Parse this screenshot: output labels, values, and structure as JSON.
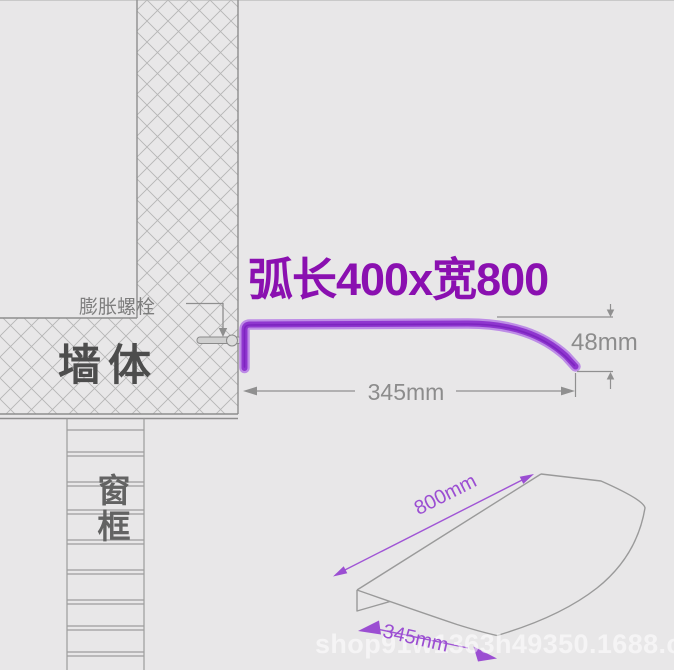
{
  "title": "弧长400x宽800",
  "cross_section": {
    "bolt_label": "膨胀螺栓",
    "wall_label": "墙体",
    "window_frame_label": "窗框",
    "dim_depth": "345mm",
    "dim_drop": "48mm"
  },
  "iso_view": {
    "dim_length": "800mm",
    "dim_depth": "345mm"
  },
  "watermark": "shop91w1363h49350.1688.com",
  "colors": {
    "background": "#e8e7e8",
    "accent_purple": "#8a10b0",
    "profile_purple": "#8f36cf",
    "dim_purple": "#9b4ed2",
    "text_dark": "#4d4d4d",
    "text_gray": "#7e7e7e",
    "dim_gray": "#8c8c8c"
  }
}
